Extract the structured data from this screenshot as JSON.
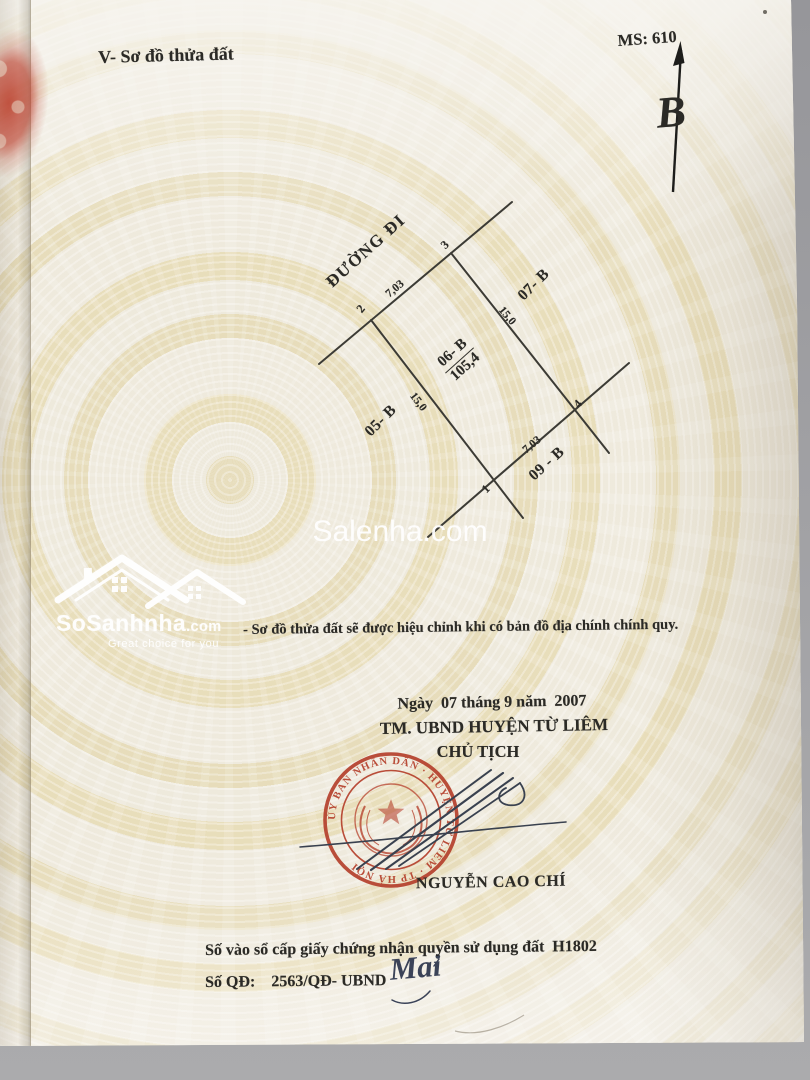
{
  "header": {
    "section_title": "V- Sơ đồ thửa đất",
    "ms_code": "MS: 610"
  },
  "north_arrow": {
    "letter": "B"
  },
  "diagram": {
    "road_label": "ĐƯỜNG ĐI",
    "plot": {
      "id": "06- B",
      "area": "105,4"
    },
    "corners": {
      "c1": "1",
      "c2": "2",
      "c3": "3",
      "c4": "4"
    },
    "dimensions": {
      "top": "7,03",
      "right": "15,0",
      "left": "15,0",
      "bottom": "7,03"
    },
    "neighbors": {
      "left": "05- B",
      "top_right": "07- B",
      "bottom": "09 - B"
    }
  },
  "watermark": {
    "site": "Salenha.com"
  },
  "logo": {
    "name": "SoSanhnha",
    "suffix": ".com",
    "tagline": "Great choice for you"
  },
  "note": "- Sơ đồ thửa đất sẽ được hiệu chỉnh khi có bản đồ địa chính chính quy.",
  "approval": {
    "date_line": "Ngày  07 tháng 9 năm  2007",
    "authority_line": "TM. UBND HUYỆN TỪ LIÊM",
    "title_line": "CHỦ TỊCH",
    "signer_name": "NGUYỄN CAO CHÍ",
    "handwritten_initial": "Mai"
  },
  "seal": {
    "ring_text": "ỦY BAN NHÂN DÂN · HUYỆN TỪ LIÊM · TP HÀ NỘI"
  },
  "registry": {
    "book_line": "Số vào sổ cấp giấy chứng nhận quyền sử dụng đất  H1802",
    "decision_line": "Số QĐ:    2563/QĐ- UBND"
  },
  "colors": {
    "seal_red": "#b5402c",
    "ink_blue": "#39414f",
    "paper": "#e7e1cf",
    "pattern_yellow": "#eadcae",
    "text_black": "#2b2a26",
    "watermark_white": "#ffffff"
  }
}
